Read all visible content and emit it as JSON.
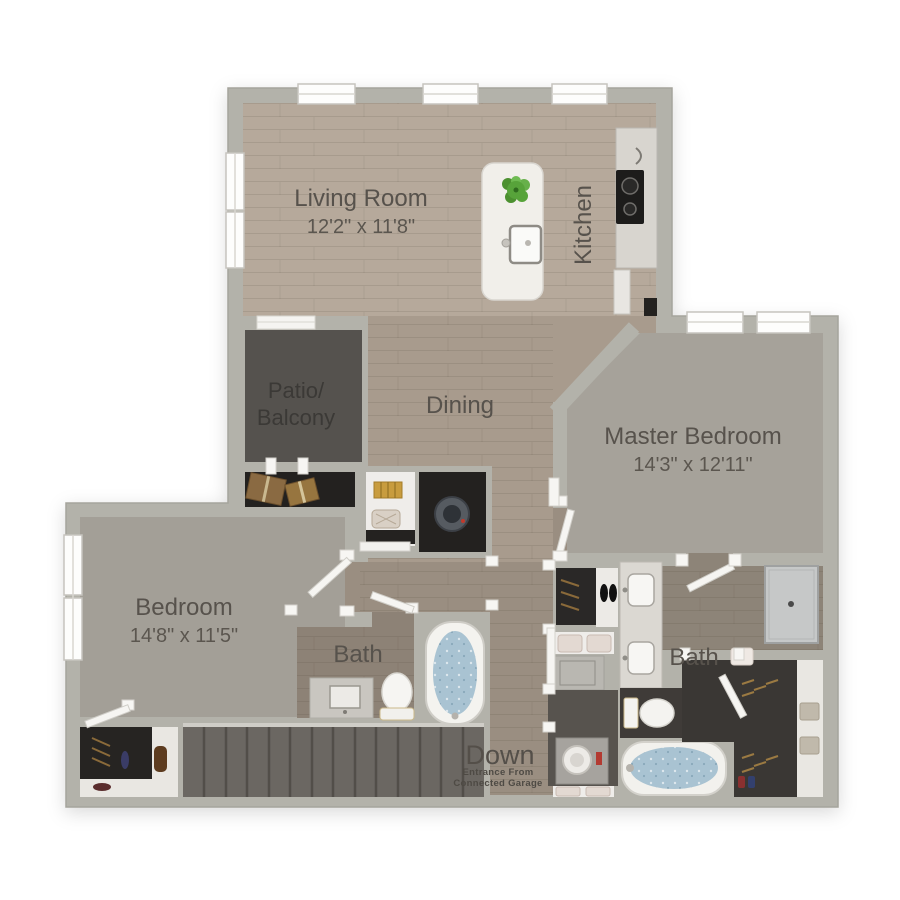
{
  "floorplan": {
    "labels": {
      "living_room": {
        "name": "Living Room",
        "dims": "12'2\" x 11'8\""
      },
      "kitchen": {
        "name": "Kitchen"
      },
      "dining": {
        "name": "Dining"
      },
      "patio": {
        "line1": "Patio/",
        "line2": "Balcony"
      },
      "master_bedroom": {
        "name": "Master Bedroom",
        "dims": "14'3\" x 12'11\""
      },
      "bedroom": {
        "name": "Bedroom",
        "dims": "14'8\" x 11'5\""
      },
      "bath_main": {
        "name": "Bath"
      },
      "bath_master": {
        "name": "Bath"
      },
      "stairs": {
        "down": "Down",
        "note_line1": "Entrance From",
        "note_line2": "Connected Garage"
      }
    },
    "colors": {
      "wall": "#b3b2aa",
      "wood_light": "#b6a99b",
      "wood_mid": "#a89b8d",
      "wood_hall": "#9a8e81",
      "wood_bath": "#8d8276",
      "carpet": "#a49f97",
      "patio_floor": "#55524e",
      "closet_dark": "#23211f",
      "stairs_floor": "#6b6762",
      "fixture_white": "#f4f3ef",
      "tub_water": "#a9c3d2",
      "label_text": "#57524c",
      "plant_green": "#57a33a"
    }
  }
}
